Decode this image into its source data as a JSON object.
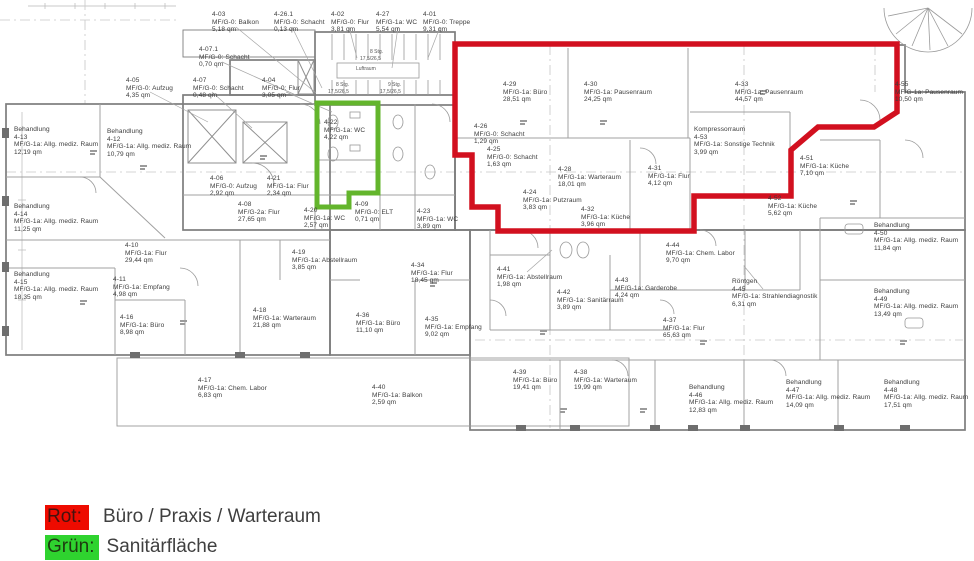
{
  "legend": {
    "items": [
      {
        "label": "Rot:",
        "text": "Büro / Praxis / Warteraum",
        "color": "#ee0b00"
      },
      {
        "label": "Grün:",
        "text": "Sanitärfläche",
        "color": "#2fd32f"
      }
    ]
  },
  "plan": {
    "colors": {
      "red_outline": "#d2101f",
      "green_outline": "#63b52c",
      "wall": "#7d7d7d"
    },
    "annotations": [
      {
        "text": "8 Stg.",
        "x": 370,
        "y": 49
      },
      {
        "text": "17,5/26,5",
        "x": 360,
        "y": 56
      },
      {
        "text": "Luftraum",
        "x": 356,
        "y": 66
      },
      {
        "text": "8 Stg.",
        "x": 336,
        "y": 82
      },
      {
        "text": "17,5/26,5",
        "x": 328,
        "y": 89
      },
      {
        "text": "9 Stg.",
        "x": 388,
        "y": 82
      },
      {
        "text": "17,5/26,5",
        "x": 380,
        "y": 89
      }
    ],
    "rooms": [
      {
        "id": "4-03",
        "x": 212,
        "y": 11,
        "lines": [
          "4-03",
          "MF/G-0: Balkon",
          "5,18 qm"
        ]
      },
      {
        "id": "4-26.1",
        "x": 274,
        "y": 11,
        "lines": [
          "4-26.1",
          "MF/G-0: Schacht",
          "0,13 qm"
        ]
      },
      {
        "id": "4-02",
        "x": 331,
        "y": 11,
        "lines": [
          "4-02",
          "MF/G-0: Flur",
          "3,81 qm"
        ]
      },
      {
        "id": "4-27",
        "x": 376,
        "y": 11,
        "lines": [
          "4-27",
          "MF/G-1a: WC",
          "5,54 qm"
        ]
      },
      {
        "id": "4-01",
        "x": 423,
        "y": 11,
        "lines": [
          "4-01",
          "MF/G-0: Treppe",
          "9,31 qm"
        ]
      },
      {
        "id": "4-07.1",
        "x": 199,
        "y": 46,
        "lines": [
          "4-07.1",
          "MF/G-0: Schacht",
          "0,70 qm"
        ]
      },
      {
        "id": "4-05",
        "x": 126,
        "y": 77,
        "lines": [
          "4-05",
          "MF/G-0: Aufzug",
          "4,35 qm"
        ]
      },
      {
        "id": "4-07",
        "x": 193,
        "y": 77,
        "lines": [
          "4-07",
          "MF/G-0: Schacht",
          "0,48 qm"
        ]
      },
      {
        "id": "4-04",
        "x": 262,
        "y": 77,
        "lines": [
          "4-04",
          "MF/G-0: Flur",
          "3,05 qm"
        ]
      },
      {
        "id": "4-29",
        "x": 503,
        "y": 81,
        "lines": [
          "4-29",
          "MF/G-1a: Büro",
          "28,51 qm"
        ]
      },
      {
        "id": "4-30",
        "x": 584,
        "y": 81,
        "lines": [
          "4-30",
          "MF/G-1a: Pausenraum",
          "24,25 qm"
        ]
      },
      {
        "id": "4-33",
        "x": 735,
        "y": 81,
        "lines": [
          "4-33",
          "MF/G-1a: Pausenraum",
          "44,57 qm"
        ]
      },
      {
        "id": "4-55",
        "x": 895,
        "y": 81,
        "lines": [
          "4-55",
          "MF/G-1a: Pausenraum",
          "10,50 qm"
        ]
      },
      {
        "id": "4-13",
        "x": 14,
        "y": 126,
        "lines": [
          "Behandlung",
          "4-13",
          "MF/G-1a: Allg. mediz. Raum",
          "12,19 qm"
        ]
      },
      {
        "id": "4-12",
        "x": 107,
        "y": 128,
        "lines": [
          "Behandlung",
          "4-12",
          "MF/G-1a: Allg. mediz. Raum",
          "10,79 qm"
        ]
      },
      {
        "id": "4-22",
        "x": 324,
        "y": 119,
        "lines": [
          "4-22",
          "MF/G-1a: WC",
          "4,22 qm"
        ]
      },
      {
        "id": "4-26",
        "x": 474,
        "y": 123,
        "lines": [
          "4-26",
          "MF/G-0: Schacht",
          "1,29 qm"
        ]
      },
      {
        "id": "4-25",
        "x": 487,
        "y": 146,
        "lines": [
          "4-25",
          "MF/G-0: Schacht",
          "1,63 qm"
        ]
      },
      {
        "id": "4-53",
        "x": 694,
        "y": 126,
        "lines": [
          "Kompressorraum",
          "4-53",
          "MF/G-1a: Sonstige Technik",
          "3,99 qm"
        ]
      },
      {
        "id": "4-28",
        "x": 558,
        "y": 166,
        "lines": [
          "4-28",
          "MF/G-1a: Warteraum",
          "18,01 qm"
        ]
      },
      {
        "id": "4-31",
        "x": 648,
        "y": 165,
        "lines": [
          "4-31",
          "MF/G-1a: Flur",
          "4,12 qm"
        ]
      },
      {
        "id": "4-51",
        "x": 800,
        "y": 155,
        "lines": [
          "4-51",
          "MF/G-1a: Küche",
          "7,10 qm"
        ]
      },
      {
        "id": "4-24",
        "x": 523,
        "y": 189,
        "lines": [
          "4-24",
          "MF/G-1a: Putzraum",
          "3,83 qm"
        ]
      },
      {
        "id": "4-06",
        "x": 210,
        "y": 175,
        "lines": [
          "4-06",
          "MF/G-0: Aufzug",
          "2,92 qm"
        ]
      },
      {
        "id": "4-21",
        "x": 267,
        "y": 175,
        "lines": [
          "4-21",
          "MF/G-1a: Flur",
          "2,34 qm"
        ]
      },
      {
        "id": "4-14",
        "x": 14,
        "y": 203,
        "lines": [
          "Behandlung",
          "4-14",
          "MF/G-1a: Allg. mediz. Raum",
          "11,25 qm"
        ]
      },
      {
        "id": "4-08",
        "x": 238,
        "y": 201,
        "lines": [
          "4-08",
          "MF/G-2a: Flur",
          "27,65 qm"
        ]
      },
      {
        "id": "4-20",
        "x": 304,
        "y": 207,
        "lines": [
          "4-20",
          "MF/G-1a: WC",
          "2,57 qm"
        ]
      },
      {
        "id": "4-09",
        "x": 355,
        "y": 201,
        "lines": [
          "4-09",
          "MF/G-0: ELT",
          "0,71 qm"
        ]
      },
      {
        "id": "4-23",
        "x": 417,
        "y": 208,
        "lines": [
          "4-23",
          "MF/G-1a: WC",
          "3,89 qm"
        ]
      },
      {
        "id": "4-32",
        "x": 581,
        "y": 206,
        "lines": [
          "4-32",
          "MF/G-1a: Küche",
          "3,96 qm"
        ]
      },
      {
        "id": "4-52",
        "x": 768,
        "y": 195,
        "lines": [
          "4-52",
          "MF/G-1a: Küche",
          "5,62 qm"
        ]
      },
      {
        "id": "4-50",
        "x": 874,
        "y": 222,
        "lines": [
          "Behandlung",
          "4-50",
          "MF/G-1a: Allg. mediz. Raum",
          "11,84 qm"
        ]
      },
      {
        "id": "4-10",
        "x": 125,
        "y": 242,
        "lines": [
          "4-10",
          "MF/G-1a: Flur",
          "29,44 qm"
        ]
      },
      {
        "id": "4-19",
        "x": 292,
        "y": 249,
        "lines": [
          "4-19",
          "MF/G-1a: Abstellraum",
          "3,85 qm"
        ]
      },
      {
        "id": "4-34",
        "x": 411,
        "y": 262,
        "lines": [
          "4-34",
          "MF/G-1a: Flur",
          "18,45 qm"
        ]
      },
      {
        "id": "4-41",
        "x": 497,
        "y": 266,
        "lines": [
          "4-41",
          "MF/G-1a: Abstellraum",
          "1,98 qm"
        ]
      },
      {
        "id": "4-42",
        "x": 557,
        "y": 289,
        "lines": [
          "4-42",
          "MF/G-1a: Sanitärraum",
          "3,89 qm"
        ]
      },
      {
        "id": "4-43",
        "x": 615,
        "y": 277,
        "lines": [
          "4-43",
          "MF/G-1a: Garderobe",
          "4,24 qm"
        ]
      },
      {
        "id": "4-44",
        "x": 666,
        "y": 242,
        "lines": [
          "4-44",
          "MF/G-1a: Chem. Labor",
          "9,70 qm"
        ]
      },
      {
        "id": "4-45",
        "x": 732,
        "y": 278,
        "lines": [
          "Röntgen",
          "4-45",
          "MF/G-1a: Strahlendiagnostik",
          "6,31 qm"
        ]
      },
      {
        "id": "4-49",
        "x": 874,
        "y": 288,
        "lines": [
          "Behandlung",
          "4-49",
          "MF/G-1a: Allg. mediz. Raum",
          "13,49 qm"
        ]
      },
      {
        "id": "4-15",
        "x": 14,
        "y": 271,
        "lines": [
          "Behandlung",
          "4-15",
          "MF/G-1a: Allg. mediz. Raum",
          "18,35 qm"
        ]
      },
      {
        "id": "4-11",
        "x": 113,
        "y": 276,
        "lines": [
          "4-11",
          "MF/G-1a: Empfang",
          "4,98 qm"
        ]
      },
      {
        "id": "4-16",
        "x": 120,
        "y": 314,
        "lines": [
          "4-16",
          "MF/G-1a: Büro",
          "8,98 qm"
        ]
      },
      {
        "id": "4-18",
        "x": 253,
        "y": 307,
        "lines": [
          "4-18",
          "MF/G-1a: Warteraum",
          "21,88 qm"
        ]
      },
      {
        "id": "4-36",
        "x": 356,
        "y": 312,
        "lines": [
          "4-36",
          "MF/G-1a: Büro",
          "11,10 qm"
        ]
      },
      {
        "id": "4-35",
        "x": 425,
        "y": 316,
        "lines": [
          "4-35",
          "MF/G-1a: Empfang",
          "9,02 qm"
        ]
      },
      {
        "id": "4-37",
        "x": 663,
        "y": 317,
        "lines": [
          "4-37",
          "MF/G-1a: Flur",
          "65,63 qm"
        ]
      },
      {
        "id": "4-17",
        "x": 198,
        "y": 377,
        "lines": [
          "4-17",
          "MF/G-1a: Chem. Labor",
          "6,83 qm"
        ]
      },
      {
        "id": "4-40",
        "x": 372,
        "y": 384,
        "lines": [
          "4-40",
          "MF/G-1a: Balkon",
          "2,59 qm"
        ]
      },
      {
        "id": "4-39",
        "x": 513,
        "y": 369,
        "lines": [
          "4-39",
          "MF/G-1a: Büro",
          "19,41 qm"
        ]
      },
      {
        "id": "4-38",
        "x": 574,
        "y": 369,
        "lines": [
          "4-38",
          "MF/G-1a: Warteraum",
          "19,99 qm"
        ]
      },
      {
        "id": "4-46",
        "x": 689,
        "y": 384,
        "lines": [
          "Behandlung",
          "4-46",
          "MF/G-1a: Allg. mediz. Raum",
          "12,83 qm"
        ]
      },
      {
        "id": "4-47",
        "x": 786,
        "y": 379,
        "lines": [
          "Behandlung",
          "4-47",
          "MF/G-1a: Allg. mediz. Raum",
          "14,09 qm"
        ]
      },
      {
        "id": "4-48",
        "x": 884,
        "y": 379,
        "lines": [
          "Behandlung",
          "4-48",
          "MF/G-1a: Allg. mediz. Raum",
          "17,51 qm"
        ]
      }
    ]
  }
}
